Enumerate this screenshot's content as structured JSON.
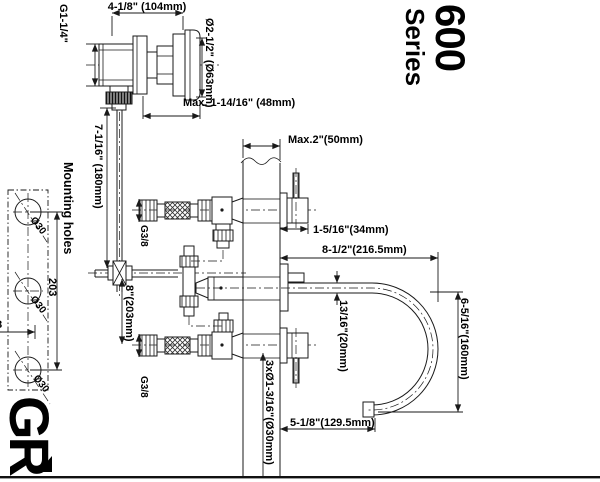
{
  "series_title": {
    "model": "600",
    "series": "Series"
  },
  "brand_logo": "GR",
  "valve_detail": {
    "width_dim": "4-1/8\" (104mm)",
    "inlet_thread": "G1-1/4\"",
    "knob_diameter": "Ø2-1/2\" (Ø63mm)",
    "max_wall": "Max. 1-14/16\" (48mm)"
  },
  "mounting_detail": {
    "label": "Mounting holes",
    "hole_d1": "Ø30",
    "hole_d2": "Ø30",
    "hole_d3": "Ø30",
    "spacing": "203",
    "edge_partial": "8"
  },
  "installation": {
    "wall_max": "Max.2\"(50mm)",
    "handle_projection": "1-5/16\"(34mm)",
    "spout_reach": "8-1/2\"(216.5mm)",
    "spout_tube_dia": "13/16\"(20mm)",
    "spout_height": "6-5/16\"(160mm)",
    "spout_drop": "5-1/8\"(129.5mm)",
    "riser_height": "7-1/16\" (180mm)",
    "valve_spacing": "8\"(203mm)",
    "wall_holes": "3xØ1-3/16\"(Ø30mm)",
    "hose_thread_top": "G3/8",
    "hose_thread_bottom": "G3/8"
  }
}
